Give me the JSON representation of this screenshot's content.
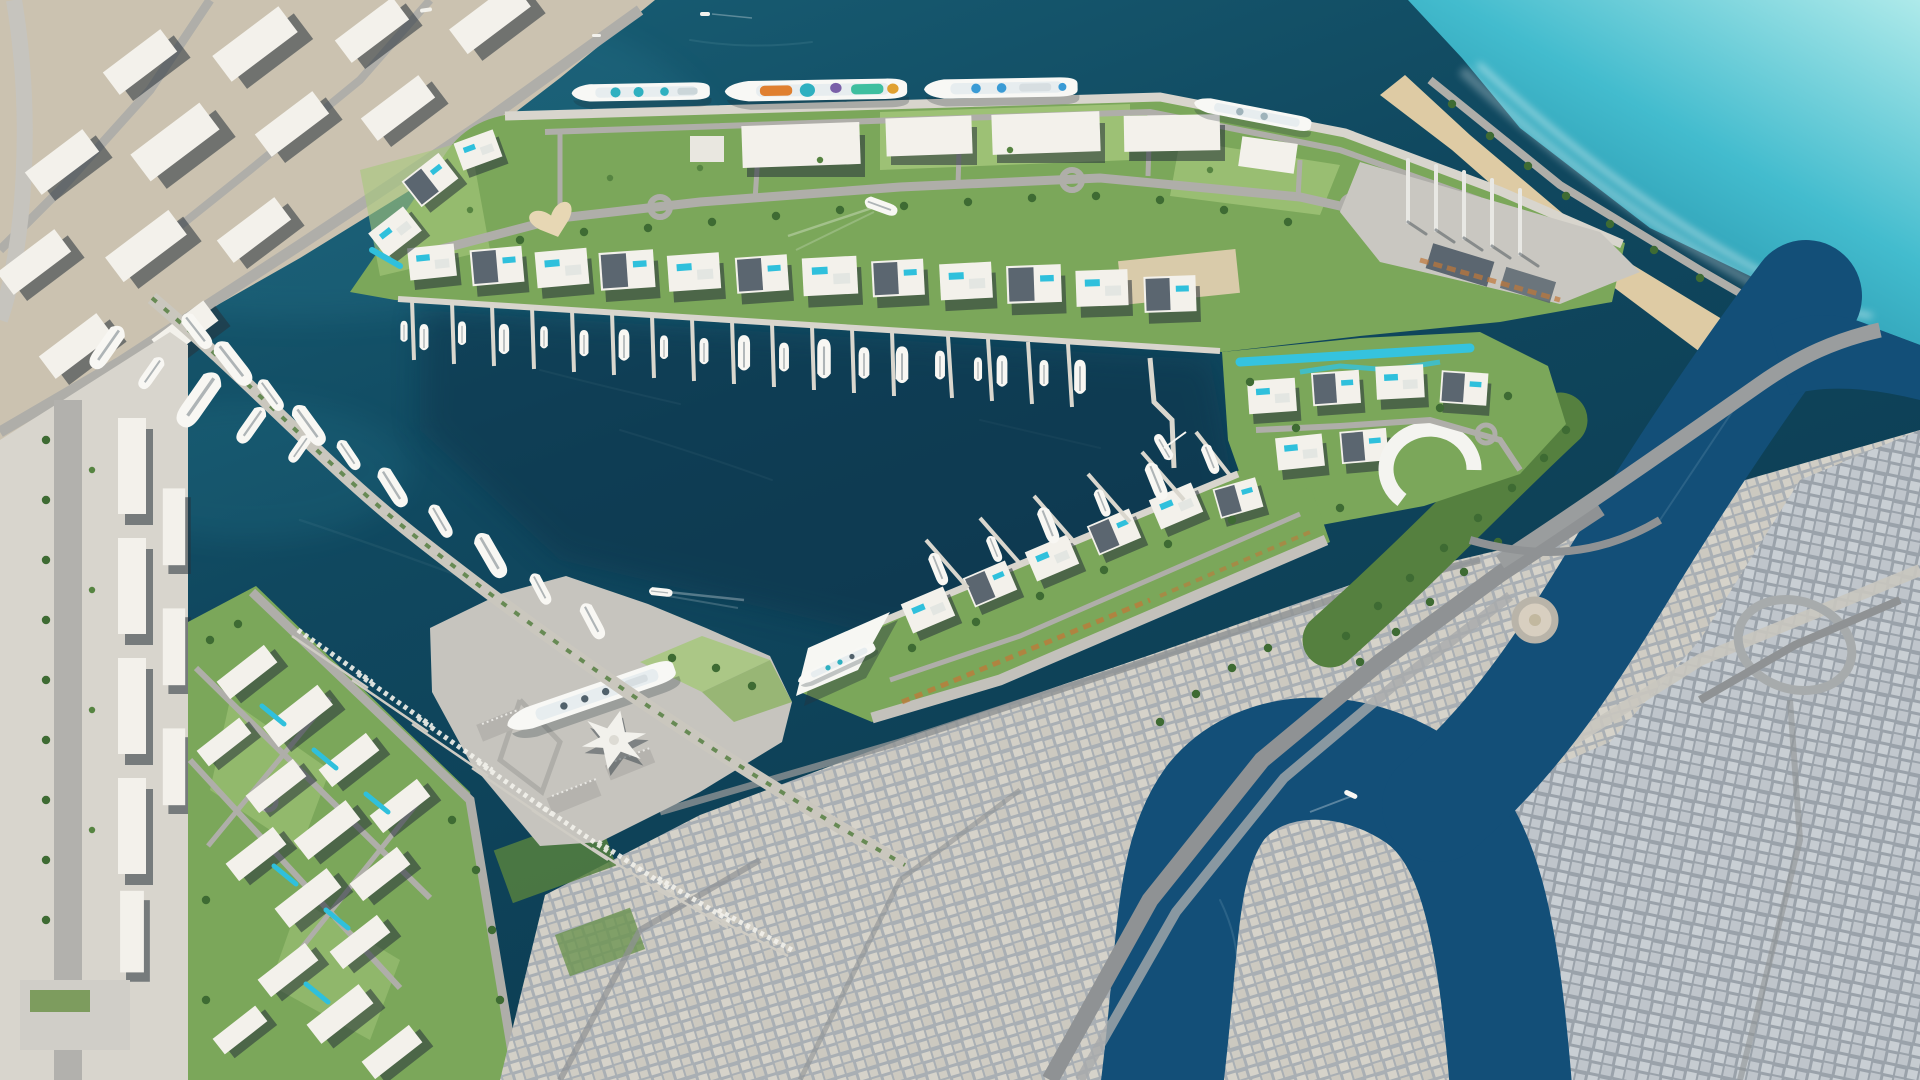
{
  "meta": {
    "title": "Aerial masterplan render of a coastal cruise-port, marina city and creek-side old town",
    "scene_type": "photorealistic aerial map render",
    "image_width": 1920,
    "image_height": 1080,
    "visible_text": "none"
  },
  "colors": {
    "seaTop": "#1A6379",
    "seaMid": "#10485F",
    "seaDeep": "#0B3A50",
    "basinShade": "#082F44",
    "coveLight": "#AEEAEA",
    "coveMid": "#43BCCE",
    "coveDeep": "#1E87A0",
    "surf": "#FFFFFF",
    "sandYard": "#CBC2B0",
    "beachSand": "#DECBA4",
    "portStrip": "#D8D5CD",
    "apron": "#C6C4BE",
    "quay": "#D8D5CD",
    "greenBase": "#7BA75A",
    "lawn": "#A6C87C",
    "treeDark": "#3E6B33",
    "parkBand": "#55803F",
    "buildingWhite": "#F6F5F1",
    "roofDark": "#5B6670",
    "buildingShadow": "#26323B",
    "road": "#AFAEA9",
    "roadDark": "#8F9294",
    "bridge": "#9A9D9E",
    "pool": "#2FC0DC",
    "lazyRiver": "#35C3DE",
    "cityWestBase": "#A9AFB4",
    "cityWestBlock": "#D6D3CA",
    "cityEastBase": "#9AA2AA",
    "cityEastBlock": "#C9CFD4",
    "creek": "#134F78",
    "yachtWhite": "#F8F7F3",
    "containerOrange": "#C07838",
    "craneWhite": "#E8E8E4",
    "heartPlaza": "#E7D7B4",
    "shipAccentTeal": "#2FB0C0",
    "shipAccentOrange": "#E08030"
  },
  "scene": {
    "water": {
      "sea_label": "harbour and open sea",
      "cove_label": "turquoise surf beach cove",
      "creek_label": "winding tidal creek",
      "basin_label": "inner marina basin"
    },
    "districts": [
      {
        "id": "industrial-sand-yard",
        "label": "North-west industrial yard with warehouses"
      },
      {
        "id": "west-port-strip",
        "label": "West dockside warehouse strip"
      },
      {
        "id": "cruise-peninsula",
        "label": "Cruise terminal peninsula with landscaped residences"
      },
      {
        "id": "east-marina-residences",
        "label": "Eastern marina residences with lazy river"
      },
      {
        "id": "south-marina-arm",
        "label": "South marina arm with sail-roof terminal"
      },
      {
        "id": "passenger-terminal",
        "label": "Passenger ship terminal with star-shaped hall"
      },
      {
        "id": "residential-quarter",
        "label": "South-west residential quarter"
      },
      {
        "id": "old-town-west",
        "label": "Old town, west creek bank"
      },
      {
        "id": "old-town-east",
        "label": "Old town, east creek bank"
      },
      {
        "id": "creek-park",
        "label": "Creek-side tree park"
      },
      {
        "id": "beach-causeway",
        "label": "North-east beach causeway"
      },
      {
        "id": "crane-berth",
        "label": "Crane berth at peninsula tip"
      }
    ],
    "vessels": {
      "cruise_ships_docked": 4,
      "ocean_liner_docked": 1,
      "terminal_ship_docked": 1,
      "large_yachts_moored": "approx 40",
      "small_craft_slips": "approx 200",
      "boats_underway": 3
    },
    "infrastructure": {
      "marina_piers": "approx 30",
      "roundabouts": 6,
      "bridges": 1,
      "highway_interchanges": 2,
      "quay_cranes": 5,
      "swimming_pools": "approx 25"
    }
  }
}
